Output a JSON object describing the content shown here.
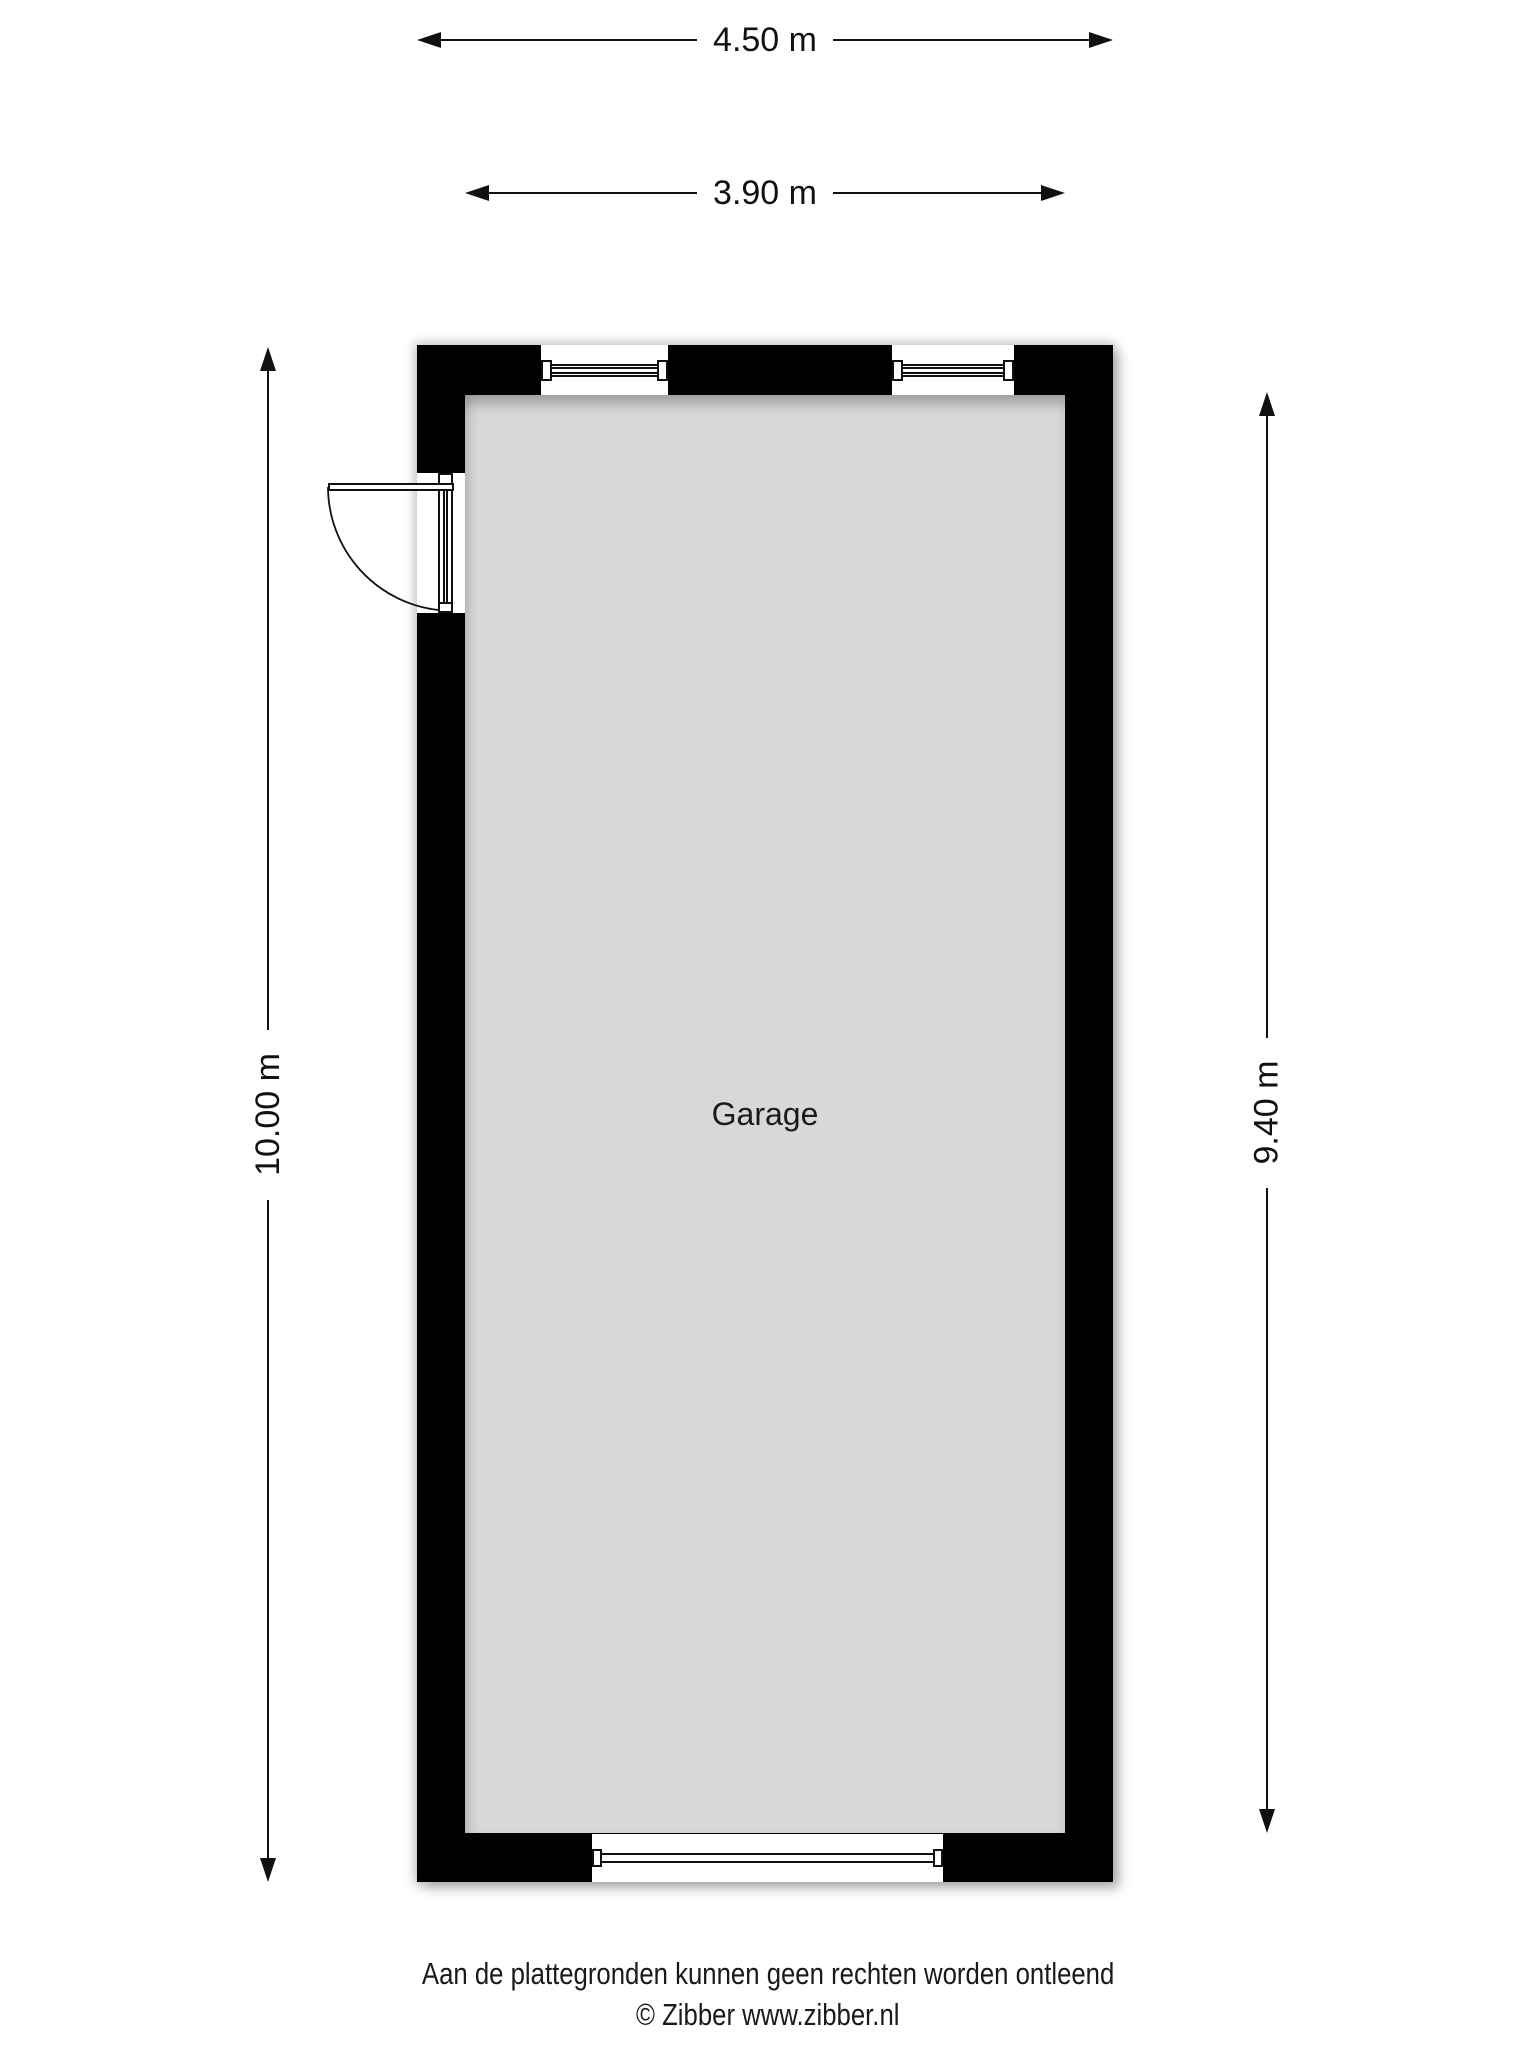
{
  "plan": {
    "room": {
      "label": "Garage"
    },
    "colors": {
      "wall": "#000000",
      "floor": "#d8d8d8",
      "line": "#111111",
      "background": "#ffffff"
    }
  },
  "dimensions": {
    "outer_width": "4.50 m",
    "inner_width": "3.90 m",
    "outer_height": "10.00 m",
    "inner_height": "9.40 m"
  },
  "footer": {
    "disclaimer": "Aan de plattegronden kunnen geen rechten worden ontleend",
    "copyright": "© Zibber www.zibber.nl"
  }
}
